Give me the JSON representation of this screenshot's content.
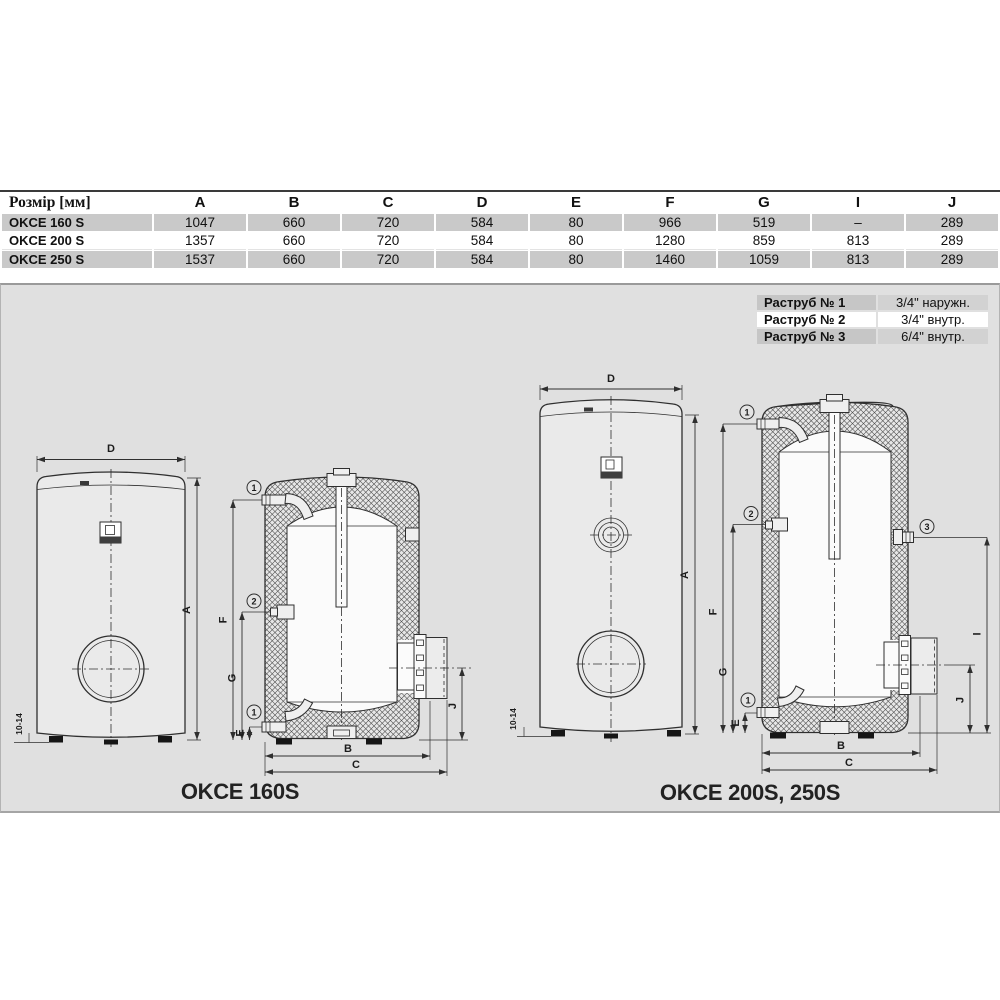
{
  "dimension_table": {
    "header_label": "Розмір [мм]",
    "columns": [
      "A",
      "B",
      "C",
      "D",
      "E",
      "F",
      "G",
      "I",
      "J"
    ],
    "rows": [
      {
        "label": "OKCE 160 S",
        "values": [
          "1047",
          "660",
          "720",
          "584",
          "80",
          "966",
          "519",
          "–",
          "289"
        ]
      },
      {
        "label": "OKCE 200 S",
        "values": [
          "1357",
          "660",
          "720",
          "584",
          "80",
          "1280",
          "859",
          "813",
          "289"
        ]
      },
      {
        "label": "OKCE 250 S",
        "values": [
          "1537",
          "660",
          "720",
          "584",
          "80",
          "1460",
          "1059",
          "813",
          "289"
        ]
      }
    ]
  },
  "socket_table": {
    "rows": [
      {
        "label": "Раструб № 1",
        "value": "3/4\" наружн."
      },
      {
        "label": "Раструб № 2",
        "value": "3/4\" внутр."
      },
      {
        "label": "Раструб № 3",
        "value": "6/4\" внутр."
      }
    ]
  },
  "drawings": {
    "left_caption": "OKCE 160S",
    "right_caption": "OKCE 200S, 250S",
    "labels": {
      "A": "A",
      "B": "B",
      "C": "C",
      "D": "D",
      "E": "E",
      "F": "F",
      "G": "G",
      "I": "I",
      "J": "J"
    },
    "callouts": {
      "n1": "1",
      "n2": "2",
      "n3": "3"
    },
    "feet_note": "10-14"
  },
  "colors": {
    "panel_background": "#e0e0e0",
    "table_row_gray": "#c9c9c9",
    "line": "#2f2f2f"
  }
}
